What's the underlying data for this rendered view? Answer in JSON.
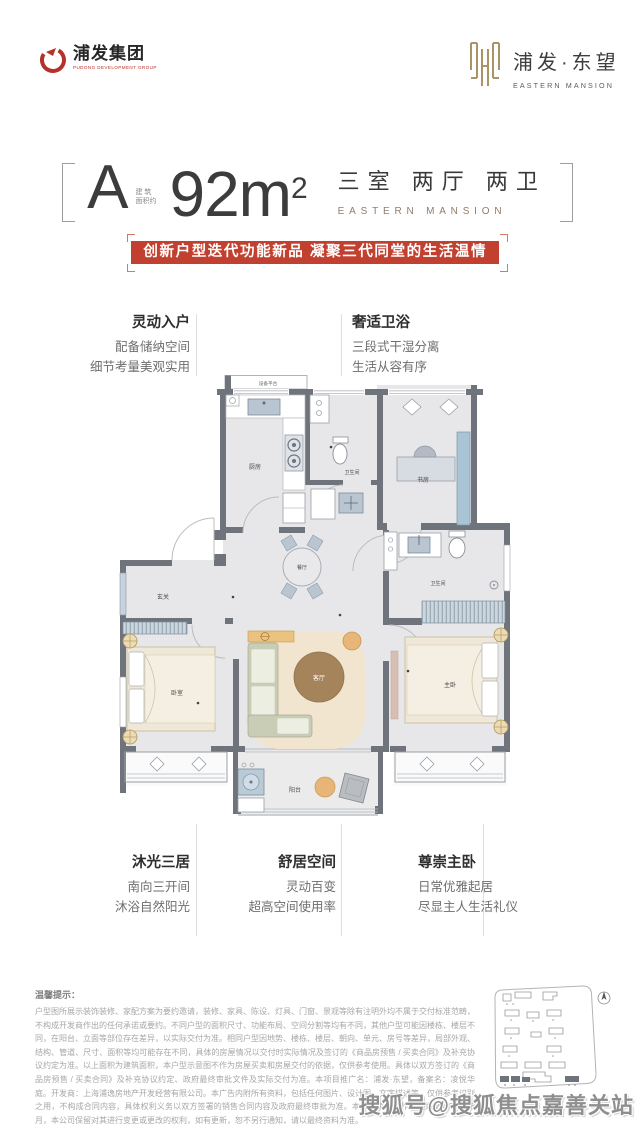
{
  "header": {
    "left_logo": {
      "name": "浦发集团",
      "tagline": "PUDONG DEVELOPMENT GROUP"
    },
    "right_logo": {
      "name": "浦发·东望",
      "subtitle": "EASTERN MANSION"
    }
  },
  "title": {
    "unit": "A",
    "area_label_top": "建 筑",
    "area_label_bottom": "面积约",
    "area_value": "92",
    "area_unit": "m",
    "area_sup": "2",
    "rooms": "三室 两厅 两卫",
    "project_en": "EASTERN MANSION"
  },
  "banner": {
    "text": "创新户型迭代功能新品 凝聚三代同堂的生活温情"
  },
  "callouts": {
    "top_left": {
      "title": "灵动入户",
      "lines": [
        "配备储纳空间",
        "细节考量美观实用"
      ]
    },
    "top_right": {
      "title": "奢适卫浴",
      "lines": [
        "三段式干湿分离",
        "生活从容有序"
      ]
    },
    "bottom_left": {
      "title": "沐光三居",
      "lines": [
        "南向三开间",
        "沐浴自然阳光"
      ]
    },
    "bottom_center": {
      "title": "舒居空间",
      "lines": [
        "灵动百变",
        "超高空间使用率"
      ]
    },
    "bottom_right": {
      "title": "尊崇主卧",
      "lines": [
        "日常优雅起居",
        "尽显主人生活礼仪"
      ]
    }
  },
  "floorplan": {
    "rooms": [
      {
        "label": "设备平台"
      },
      {
        "label": "厨房"
      },
      {
        "label": "卫生间"
      },
      {
        "label": "书房"
      },
      {
        "label": "餐厅"
      },
      {
        "label": "玄关"
      },
      {
        "label": "卫生间"
      },
      {
        "label": "卧室"
      },
      {
        "label": "客厅"
      },
      {
        "label": "主卧"
      },
      {
        "label": "阳台"
      }
    ]
  },
  "disclaimer": {
    "title": "温馨提示：",
    "body": "户型图所展示装饰装修、家配方案为要约邀请，装修、家具、陈设、灯具、门窗、景观等除有注明外均不属于交付标准范畴，不构成开发商作出的任何承诺或要约。不同户型的面积尺寸、功能布局、空间分割等均有不同，其他户型可能因楼栋、楼层不同，在阳台、立面等部位存在差异，以实际交付为准。相同户型因地势、楼栋、楼层、朝向、单元、房号等差异，局部外观、结构、管道、尺寸、面积等均可能存在不同，具体的房屋情况以交付时实际情况及签订的《商品房预售 / 买卖合同》及补充协议约定为准。以上面积为建筑面积，本户型示意图不作为房屋买卖和房屋交付的依据，仅供参考使用。具体以双方签订的《商品房预售 / 买卖合同》及补充协议约定、政府最终审批文件及实际交付为准。本项目推广名：浦发·东望，备案名：凌悦华庭。开发商：上海浦逸房地产开发经营有限公司。本广告内附所有资料，包括任何图片、设计图、文字描述等，仅供参考识别之用，不构成合同内容，具体权利义务以双方签署的销售合同内容及政府最终审批为准。本宣传资料制作时间为 2023 年 08 月，本公司保留对其进行变更或更改的权利，如有更新，恕不另行通知，请以最终资料为准。"
  },
  "watermark": {
    "text": "搜狐号@搜狐焦点嘉善关站"
  },
  "colors": {
    "accent_red": "#c2402f",
    "brand_gold": "#ab9368",
    "wall_gray": "#6e737c",
    "floor_gray": "#e7e7e9"
  }
}
